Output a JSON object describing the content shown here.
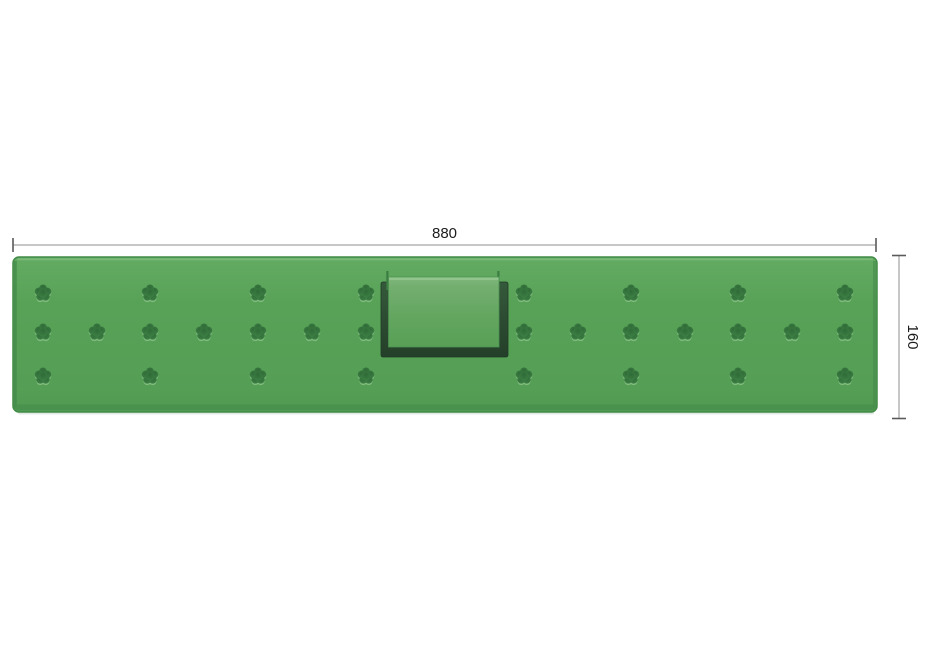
{
  "drawing": {
    "width_dimension": {
      "label": "880"
    },
    "height_dimension": {
      "label": "160"
    }
  },
  "colors": {
    "background": "#ffffff",
    "panel_face_light": "#63ab62",
    "panel_face": "#58a258",
    "panel_face_dark": "#4f9a51",
    "panel_edge": "#418b47",
    "panel_top_highlight": "#7fbb7d",
    "panel_side_shade": "#43894a",
    "fastener_dark_center": "#2f6a37",
    "fastener_dark_rim": "#3f8347",
    "fastener_highlight": "#86c083",
    "recess_dark_top": "#35593b",
    "recess_dark_bottom": "#243f29",
    "plate_top": "#82b87e",
    "plate_mid": "#64a661",
    "plate_bottom": "#58a055",
    "dimension_line": "#8f8f8f",
    "dimension_tick": "#5a5a5a",
    "dimension_text": "#1c1c1c"
  },
  "panel": {
    "fastener_rows": [
      {
        "y": 293,
        "xs": [
          43,
          150,
          258,
          366,
          524,
          631,
          738,
          845
        ]
      },
      {
        "y": 332,
        "xs": [
          43,
          97,
          150,
          204,
          258,
          312,
          366,
          524,
          578,
          631,
          685,
          738,
          792,
          845
        ]
      },
      {
        "y": 376,
        "xs": [
          43,
          150,
          258,
          366,
          524,
          631,
          738,
          845
        ]
      }
    ]
  }
}
